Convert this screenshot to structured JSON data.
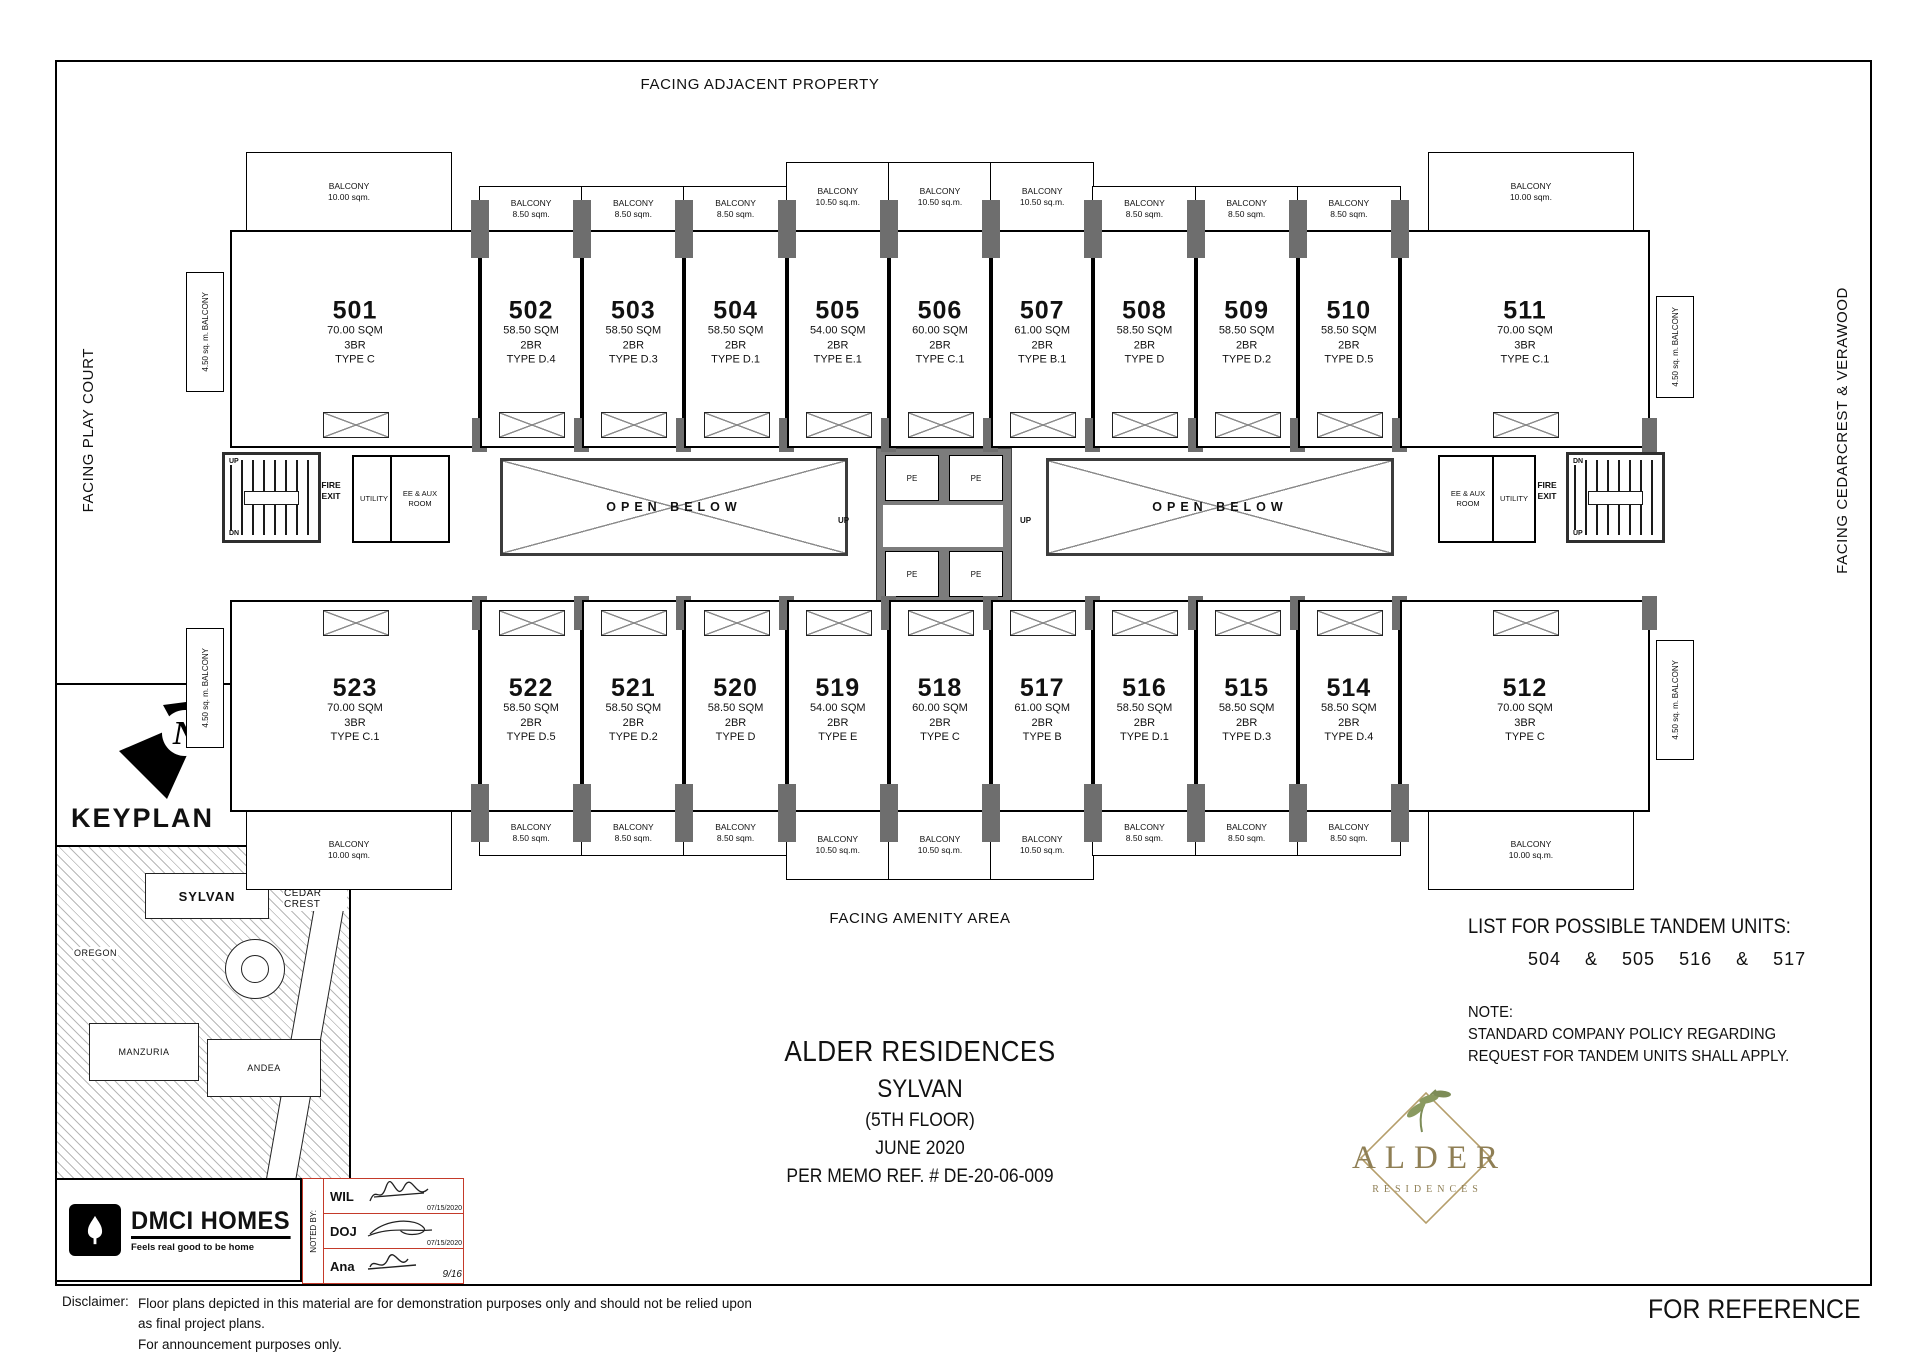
{
  "sheet": {
    "facing_top": "FACING ADJACENT PROPERTY",
    "facing_left": "FACING PLAY COURT",
    "facing_right": "FACING CEDARCREST & VERAWOOD",
    "facing_bottom": "FACING AMENITY AREA",
    "for_reference": "FOR REFERENCE",
    "disclaimer_label": "Disclaimer:",
    "disclaimer_line1": "Floor plans depicted in this material are for demonstration purposes only and should not be relied upon as final project plans.",
    "disclaimer_line2": "For announcement purposes only."
  },
  "title_block": {
    "project": "ALDER RESIDENCES",
    "building": "SYLVAN",
    "floor": "(5TH FLOOR)",
    "date": "JUNE 2020",
    "memo": "PER MEMO REF. # DE-20-06-009"
  },
  "tandem": {
    "heading": "LIST FOR POSSIBLE TANDEM UNITS:",
    "pairs": "504 & 505    516 & 517",
    "note_label": "NOTE:",
    "note_line1": "STANDARD COMPANY POLICY REGARDING",
    "note_line2": "REQUEST FOR TANDEM UNITS SHALL APPLY."
  },
  "core": {
    "open_below": "OPEN BELOW",
    "pe": "PE",
    "up": "UP",
    "dn": "DN",
    "fire_exit": "FIRE EXIT",
    "utility": "UTILITY",
    "ee_aux": "EE & AUX ROOM"
  },
  "keyplan": {
    "label": "KEYPLAN",
    "north": "N",
    "sylvan": "SYLVAN",
    "cedar_crest": "CEDAR CREST",
    "oregon": "OREGON",
    "manzuria": "MANZURIA",
    "andea": "ANDEA"
  },
  "brand": {
    "dmci": "DMCI HOMES",
    "tagline": "Feels real good to be home",
    "alder": "ALDER",
    "residences": "RESIDENCES"
  },
  "noted_by": {
    "label": "NOTED BY:",
    "rows": [
      {
        "name": "WIL",
        "date": "07/15/2020"
      },
      {
        "name": "DOJ",
        "date": "07/15/2020"
      },
      {
        "name": "Ana",
        "date": "9/16"
      }
    ]
  },
  "side_balcony": {
    "label": "BALCONY",
    "area": "4.50 sq. m."
  },
  "units_top": [
    {
      "no": "501",
      "area": "70.00 SQM",
      "br": "3BR",
      "type": "TYPE C",
      "balcony_label": "BALCONY",
      "balcony_area": "10.00 sqm.",
      "kind": "corner-left"
    },
    {
      "no": "502",
      "area": "58.50 SQM",
      "br": "2BR",
      "type": "TYPE D.4",
      "balcony_label": "BALCONY",
      "balcony_area": "8.50 sqm.",
      "kind": "regular"
    },
    {
      "no": "503",
      "area": "58.50 SQM",
      "br": "2BR",
      "type": "TYPE D.3",
      "balcony_label": "BALCONY",
      "balcony_area": "8.50 sqm.",
      "kind": "regular"
    },
    {
      "no": "504",
      "area": "58.50 SQM",
      "br": "2BR",
      "type": "TYPE D.1",
      "balcony_label": "BALCONY",
      "balcony_area": "8.50 sqm.",
      "kind": "regular"
    },
    {
      "no": "505",
      "area": "54.00 SQM",
      "br": "2BR",
      "type": "TYPE E.1",
      "balcony_label": "BALCONY",
      "balcony_area": "10.50 sq.m.",
      "kind": "center"
    },
    {
      "no": "506",
      "area": "60.00 SQM",
      "br": "2BR",
      "type": "TYPE C.1",
      "balcony_label": "BALCONY",
      "balcony_area": "10.50 sq.m.",
      "kind": "center"
    },
    {
      "no": "507",
      "area": "61.00 SQM",
      "br": "2BR",
      "type": "TYPE B.1",
      "balcony_label": "BALCONY",
      "balcony_area": "10.50 sq.m.",
      "kind": "center"
    },
    {
      "no": "508",
      "area": "58.50 SQM",
      "br": "2BR",
      "type": "TYPE D",
      "balcony_label": "BALCONY",
      "balcony_area": "8.50 sqm.",
      "kind": "regular"
    },
    {
      "no": "509",
      "area": "58.50 SQM",
      "br": "2BR",
      "type": "TYPE D.2",
      "balcony_label": "BALCONY",
      "balcony_area": "8.50 sqm.",
      "kind": "regular"
    },
    {
      "no": "510",
      "area": "58.50 SQM",
      "br": "2BR",
      "type": "TYPE D.5",
      "balcony_label": "BALCONY",
      "balcony_area": "8.50 sqm.",
      "kind": "regular"
    },
    {
      "no": "511",
      "area": "70.00 SQM",
      "br": "3BR",
      "type": "TYPE C.1",
      "balcony_label": "BALCONY",
      "balcony_area": "10.00 sqm.",
      "kind": "corner-right"
    }
  ],
  "units_bottom": [
    {
      "no": "523",
      "area": "70.00 SQM",
      "br": "3BR",
      "type": "TYPE C.1",
      "balcony_label": "BALCONY",
      "balcony_area": "10.00 sqm.",
      "kind": "corner-left"
    },
    {
      "no": "522",
      "area": "58.50 SQM",
      "br": "2BR",
      "type": "TYPE D.5",
      "balcony_label": "BALCONY",
      "balcony_area": "8.50 sqm.",
      "kind": "regular"
    },
    {
      "no": "521",
      "area": "58.50 SQM",
      "br": "2BR",
      "type": "TYPE D.2",
      "balcony_label": "BALCONY",
      "balcony_area": "8.50 sqm.",
      "kind": "regular"
    },
    {
      "no": "520",
      "area": "58.50 SQM",
      "br": "2BR",
      "type": "TYPE D",
      "balcony_label": "BALCONY",
      "balcony_area": "8.50 sqm.",
      "kind": "regular"
    },
    {
      "no": "519",
      "area": "54.00 SQM",
      "br": "2BR",
      "type": "TYPE E",
      "balcony_label": "BALCONY",
      "balcony_area": "10.50 sq.m.",
      "kind": "center"
    },
    {
      "no": "518",
      "area": "60.00 SQM",
      "br": "2BR",
      "type": "TYPE C",
      "balcony_label": "BALCONY",
      "balcony_area": "10.50 sq.m.",
      "kind": "center"
    },
    {
      "no": "517",
      "area": "61.00 SQM",
      "br": "2BR",
      "type": "TYPE B",
      "balcony_label": "BALCONY",
      "balcony_area": "10.50 sq.m.",
      "kind": "center"
    },
    {
      "no": "516",
      "area": "58.50 SQM",
      "br": "2BR",
      "type": "TYPE D.1",
      "balcony_label": "BALCONY",
      "balcony_area": "8.50 sqm.",
      "kind": "regular"
    },
    {
      "no": "515",
      "area": "58.50 SQM",
      "br": "2BR",
      "type": "TYPE D.3",
      "balcony_label": "BALCONY",
      "balcony_area": "8.50 sqm.",
      "kind": "regular"
    },
    {
      "no": "514",
      "area": "58.50 SQM",
      "br": "2BR",
      "type": "TYPE D.4",
      "balcony_label": "BALCONY",
      "balcony_area": "8.50 sqm.",
      "kind": "regular"
    },
    {
      "no": "512",
      "area": "70.00 SQM",
      "br": "3BR",
      "type": "TYPE C",
      "balcony_label": "BALCONY",
      "balcony_area": "10.00 sq.m.",
      "kind": "corner-right"
    }
  ]
}
